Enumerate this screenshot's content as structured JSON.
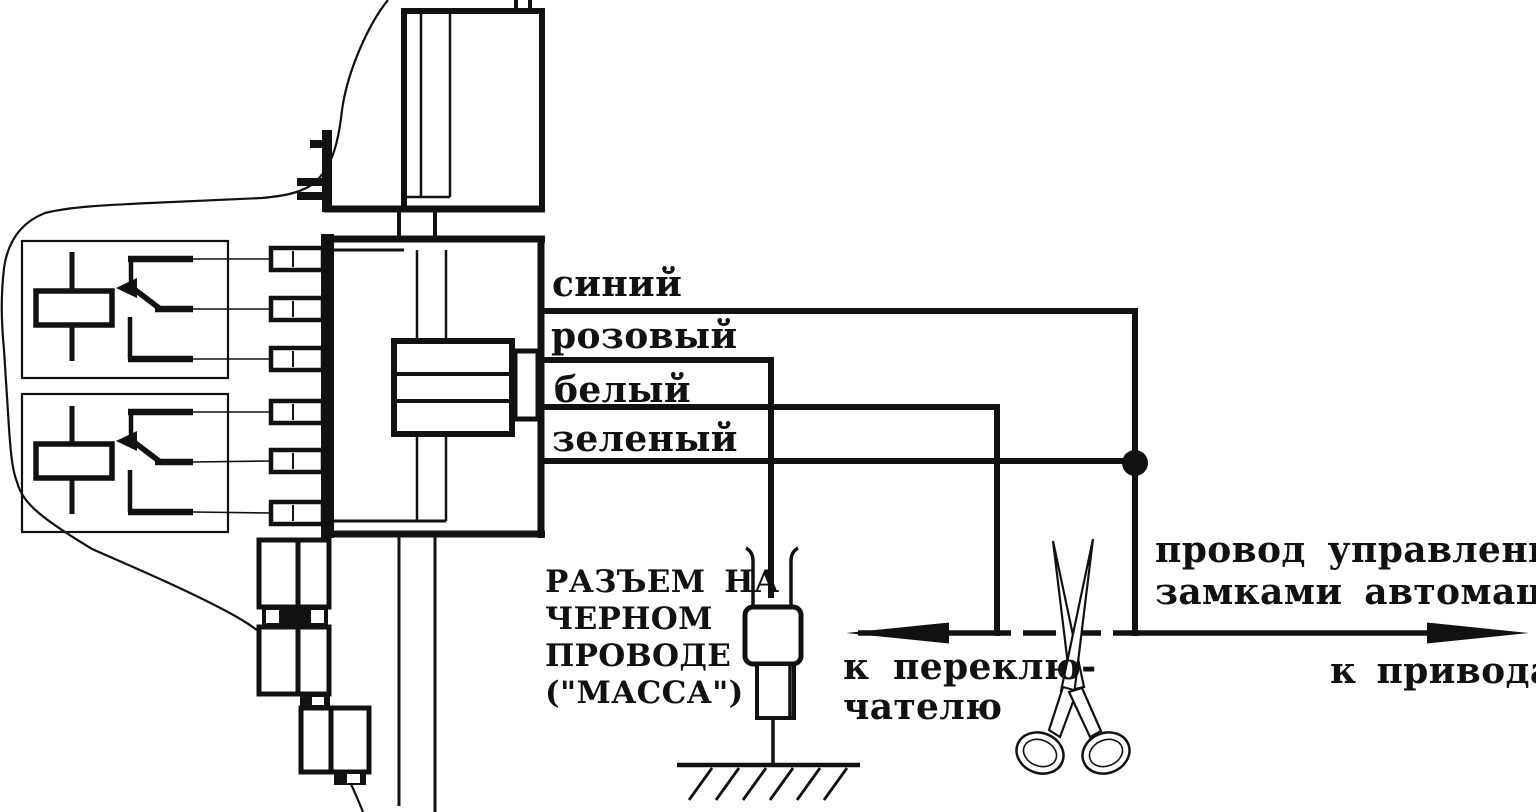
{
  "canvas": {
    "ink_color": "#111111",
    "paper_color": "#ffffff"
  },
  "wire_labels": {
    "blue": "синий",
    "pink": "розовый",
    "white": "белый",
    "green": "зеленый"
  },
  "ground_connector_note": {
    "line1": "РАЗЪЕМ НА",
    "line2": "ЧЕРНОМ",
    "line3": "ПРОВОДЕ",
    "line4": "(\"МАССА\")"
  },
  "control_wire_note": {
    "line1": "провод управления",
    "line2": "замками автомашины"
  },
  "to_switch_label": {
    "line1": "к переклю-",
    "line2": "чателю"
  },
  "to_actuators_label": "к приводам"
}
